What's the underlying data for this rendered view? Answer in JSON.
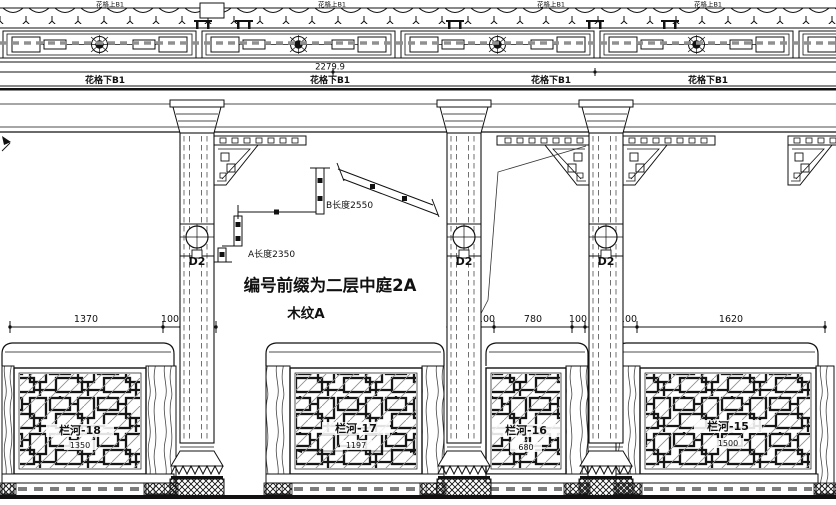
{
  "drawing": {
    "note_title": "编号前缀为二层中庭2A",
    "note_wood": "木纹A",
    "band": {
      "upper_label": "花格上B1",
      "lower_label": "花格下B1",
      "span_dimension": "2279.9"
    },
    "column_tag": "D2",
    "detail": {
      "a_length": "A长度2350",
      "b_length": "B长度2550"
    },
    "dims_left": {
      "d0": "1370",
      "d1": "100",
      "d2": "240"
    },
    "dims_right": {
      "d0": "240",
      "d1": "100",
      "d2": "780",
      "d3": "100",
      "d4": "240",
      "d5": "100",
      "d6": "1620"
    },
    "panels": [
      {
        "label": "栏河-18",
        "width": "1350"
      },
      {
        "label": "栏河-17",
        "width": "1197"
      },
      {
        "label": "栏河-16",
        "width": "680"
      },
      {
        "label": "栏河-15",
        "width": "1500"
      }
    ]
  }
}
